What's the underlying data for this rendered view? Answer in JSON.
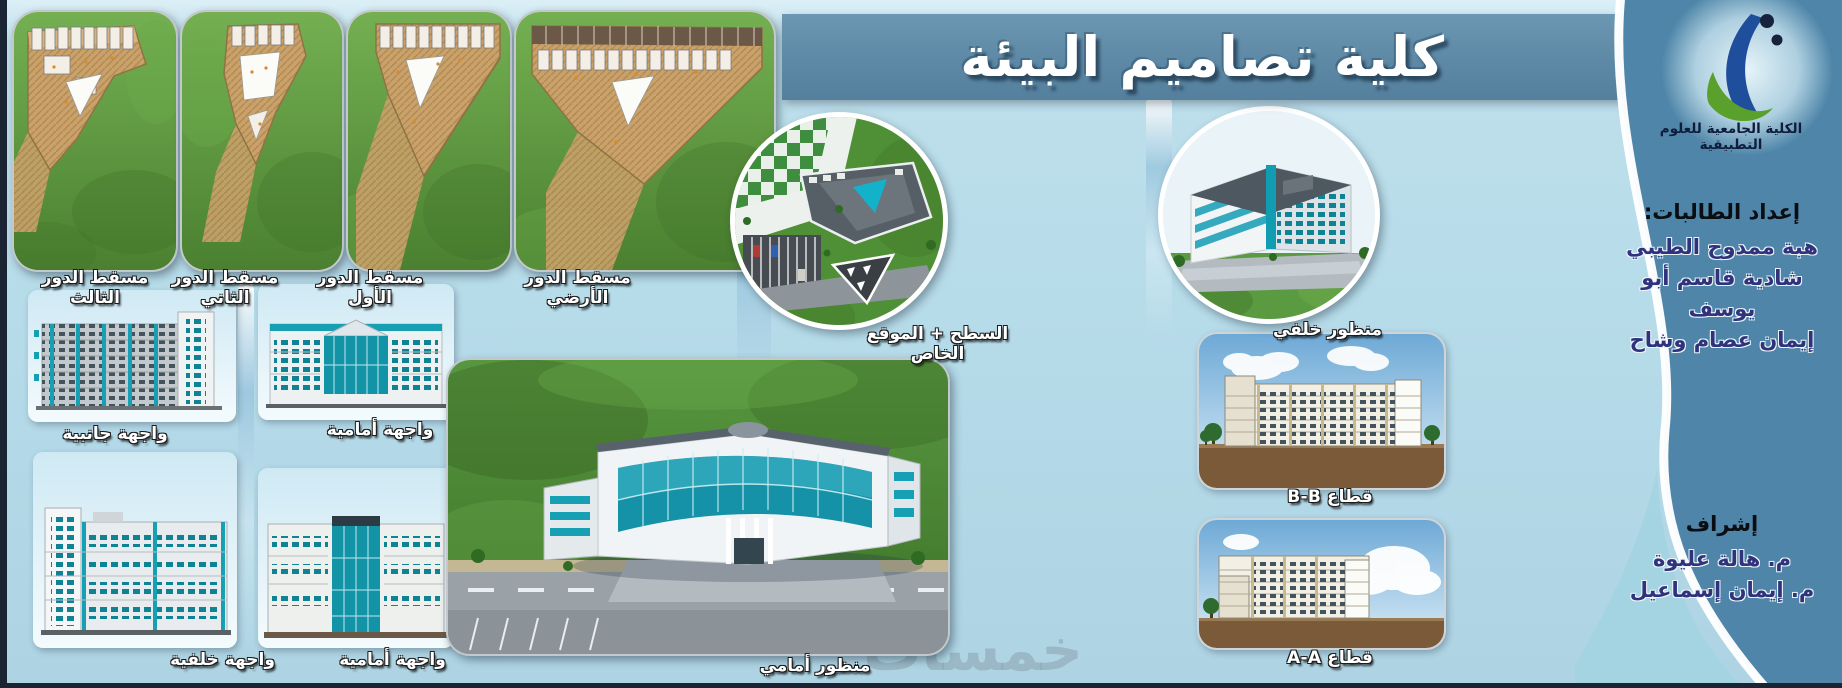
{
  "board": {
    "title": "كلية تصاميم البيئة",
    "watermark": "خمسات"
  },
  "floor_plans": [
    {
      "label": "مسقط الدور الثالث"
    },
    {
      "label": "مسقط الدور الثاني"
    },
    {
      "label": "مسقط الدور الأول"
    },
    {
      "label": "مسقط الدور الأرضي"
    }
  ],
  "roof_site": {
    "label": "السطح + الموقع الخاص"
  },
  "back_view": {
    "label": "منظور خلفي"
  },
  "elevations": [
    {
      "label": "واجهة جانبية"
    },
    {
      "label": "واجهة أمامية"
    },
    {
      "label": "واجهة خلفية"
    },
    {
      "label": "واجهة أمامية"
    }
  ],
  "front_view": {
    "label": "منظور أمامي"
  },
  "sections": [
    {
      "label": "قطاع B-B"
    },
    {
      "label": "قطاع A-A"
    }
  ],
  "sidebar": {
    "logo_caption": "الكلية الجامعية للعلوم التطبيقية",
    "students_heading": "إعداد الطالبات:",
    "students": [
      {
        "name": "هبة ممدوح الطيبي"
      },
      {
        "name": "شادية قاسم أبو يوسف"
      },
      {
        "name": "إيمان عصام وشاح"
      }
    ],
    "supervision_heading": "إشراف",
    "supervisors": [
      {
        "name": "م. هالة عليوة"
      },
      {
        "name": "م. إيمان إسماعيل"
      }
    ]
  },
  "colors": {
    "banner_blue": "#5d89a6",
    "panel_blue": "#4e85a8",
    "teal_accent": "#17a0b4",
    "grass_green": "#5a9a40",
    "plan_tan": "#c9a169",
    "logo_blue": "#1f4e9c",
    "logo_green": "#5aa02c"
  }
}
